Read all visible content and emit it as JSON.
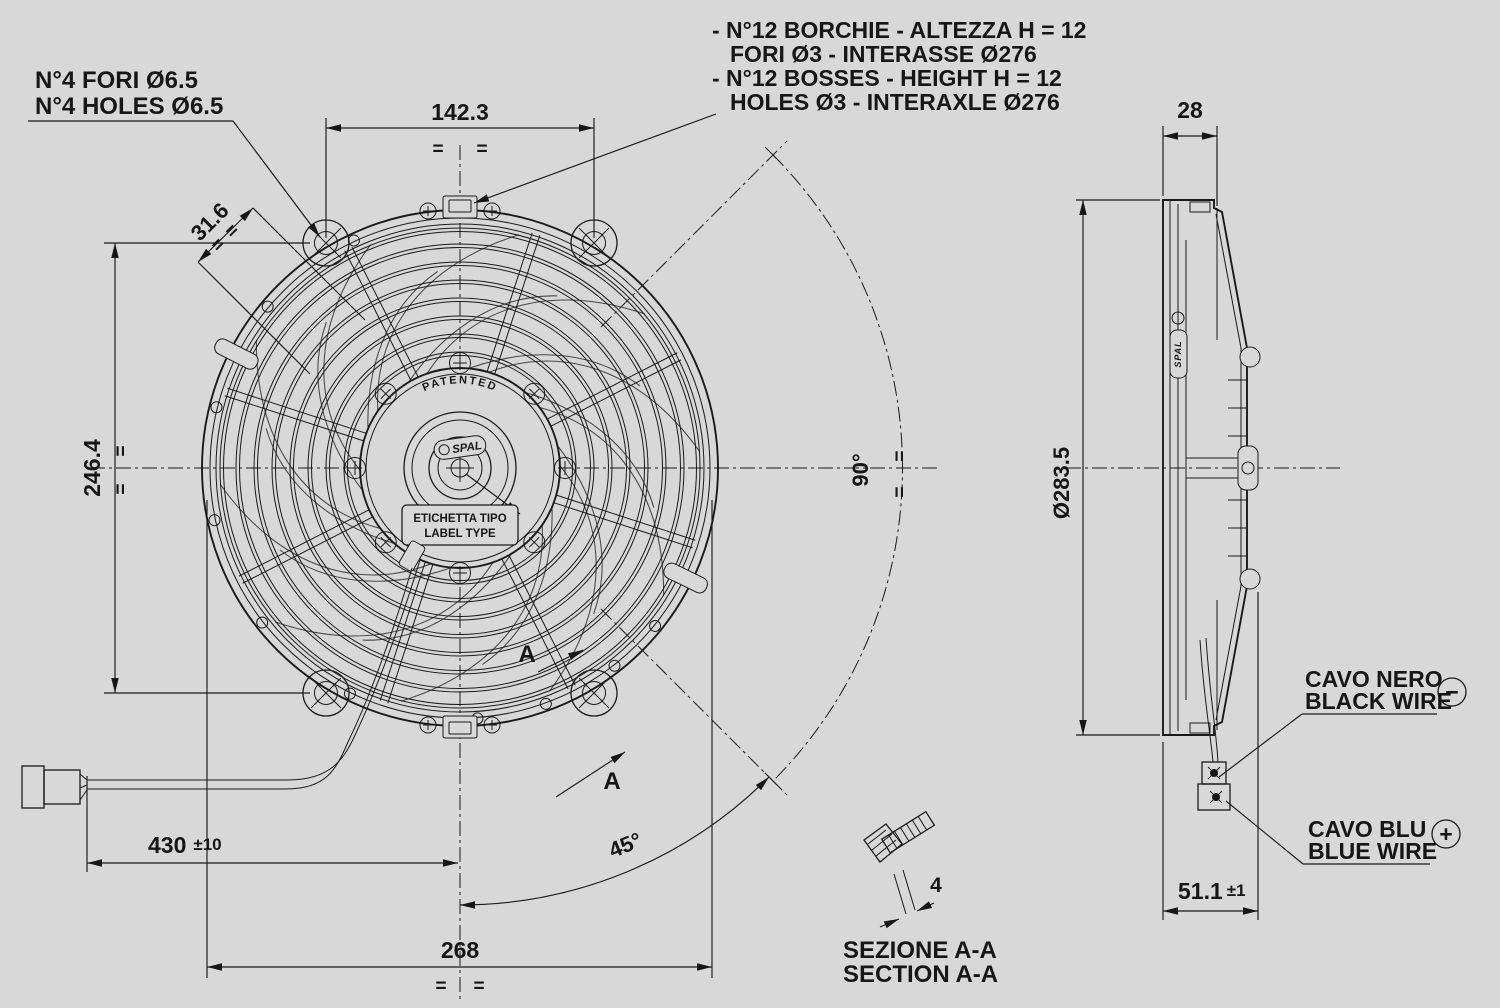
{
  "colors": {
    "background": "#d8d8d8",
    "line": "#1a1a1a"
  },
  "notes": {
    "holes_line1": "N°4 FORI Ø6.5",
    "holes_line2": "N°4 HOLES Ø6.5",
    "bosses_line1": "- N°12 BORCHIE - ALTEZZA H = 12",
    "bosses_line2": "FORI Ø3 - INTERASSE Ø276",
    "bosses_line3": "- N°12 BOSSES - HEIGHT H = 12",
    "bosses_line4": "HOLES Ø3 - INTERAXLE Ø276"
  },
  "front": {
    "dim_top": "142.3",
    "dim_offset": "31.6",
    "dim_height": "246.4",
    "dim_cable": "430",
    "dim_cable_tol": "±10",
    "dim_width": "268",
    "angle_half": "45°",
    "angle_full": "90°",
    "sym": "=",
    "patented": "PATENTED",
    "brand": "SPAL",
    "label_line1": "ETICHETTA TIPO",
    "label_line2": "LABEL TYPE",
    "section_letter": "A"
  },
  "side": {
    "dim_depth": "28",
    "dim_diameter": "Ø283.5",
    "dim_total": "51.1",
    "dim_total_tol": "±1"
  },
  "wires": {
    "black_line1": "CAVO NERO",
    "black_line2": "BLACK WIRE",
    "black_symbol": "−",
    "blue_line1": "CAVO BLU",
    "blue_line2": "BLUE WIRE",
    "blue_symbol": "+"
  },
  "section": {
    "dim_thickness": "4",
    "title_line1": "SEZIONE A-A",
    "title_line2": "SECTION A-A"
  }
}
